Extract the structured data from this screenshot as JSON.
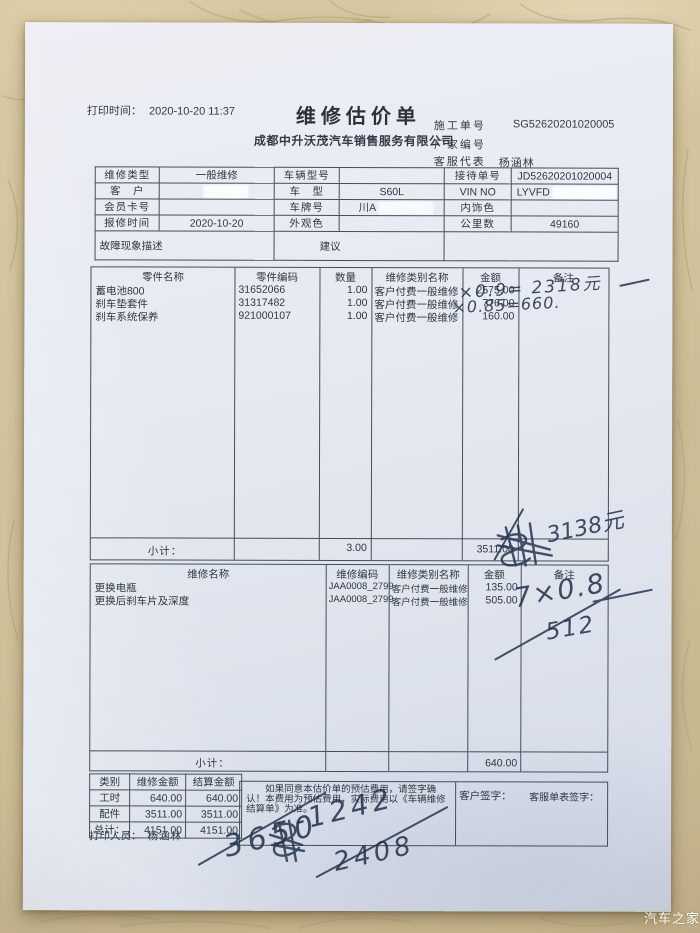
{
  "watermark": "汽车之家",
  "colors": {
    "paper": "#e7eaf1",
    "marble": "#d0c19b",
    "ink": "#26354f",
    "print_text": "#333b47"
  },
  "meta": {
    "print_label": "打印时间：",
    "print_time": "2020-10-20 11:37",
    "title": "维修估价单",
    "company": "成都中升沃茂汽车销售服务有限公司",
    "rows": [
      {
        "label": "施工单号",
        "value": "SG52620201020005"
      },
      {
        "label": "厂家编号",
        "value": ""
      },
      {
        "label": "客服代表",
        "value": "杨涵林"
      }
    ]
  },
  "info_rows": [
    [
      "维修类型",
      "一般维修",
      "车辆型号",
      "",
      "接待单号",
      "JD52620201020004"
    ],
    [
      "客　户",
      "",
      "车　型",
      "S60L",
      "VIN NO",
      "LYVFD"
    ],
    [
      "会员卡号",
      "",
      "车牌号",
      "川A",
      "内饰色",
      ""
    ],
    [
      "报修时间",
      "2020-10-20",
      "外观色",
      "",
      "公里数",
      "49160"
    ],
    [
      "故障现象描述",
      "建议",
      ""
    ]
  ],
  "parts": {
    "headers": [
      "零件名称",
      "零件编码",
      "数量",
      "维修类别名称",
      "金额",
      "备注"
    ],
    "rows": [
      [
        "蓄电池800",
        "31652066",
        "1.00",
        "客户付费一般维修",
        "2575.00"
      ],
      [
        "刹车垫套件",
        "31317482",
        "1.00",
        "客户付费一般维修",
        "776.00"
      ],
      [
        "刹车系统保养",
        "921000107",
        "1.00",
        "客户付费一般维修",
        "160.00"
      ]
    ],
    "subtotal_label": "小计：",
    "subtotal_qty": "3.00",
    "subtotal_amount": "3511.00"
  },
  "labor": {
    "headers": [
      "维修名称",
      "维修编码",
      "维修类别名称",
      "金额",
      "备注"
    ],
    "rows": [
      [
        "更换电瓶",
        "JAA0008_2799",
        "客户付费一般维修",
        "135.00"
      ],
      [
        "更换后刹车片及深度",
        "JAA0008_2799",
        "客户付费一般维修",
        "505.00"
      ]
    ],
    "subtotal_label": "小计：",
    "subtotal_amount": "640.00"
  },
  "summary": {
    "headers": [
      "类别",
      "维修金额",
      "结算金额"
    ],
    "rows": [
      [
        "工时",
        "640.00",
        "640.00"
      ],
      [
        "配件",
        "3511.00",
        "3511.00"
      ],
      [
        "总计：",
        "4151.00",
        "4151.00"
      ]
    ]
  },
  "notice": "如果同意本估价单的预估费用，请签字确认！本费用为预估费用，实际费用以《车辆维修结算单》为准。",
  "signs": {
    "customer": "客户签字：",
    "service": "客服单表签字："
  },
  "printer": {
    "label": "打印人员：",
    "name": "杨涵林"
  },
  "handwriting": {
    "parts_note1": "×0.9= 2318元",
    "parts_note2": "×0.85=660.",
    "parts_subtotal_note": "3138元",
    "labor_note1": "7×0.8",
    "labor_note2": "512",
    "calc1": "3650",
    "calc2": "-1242",
    "calc3": "2408"
  }
}
